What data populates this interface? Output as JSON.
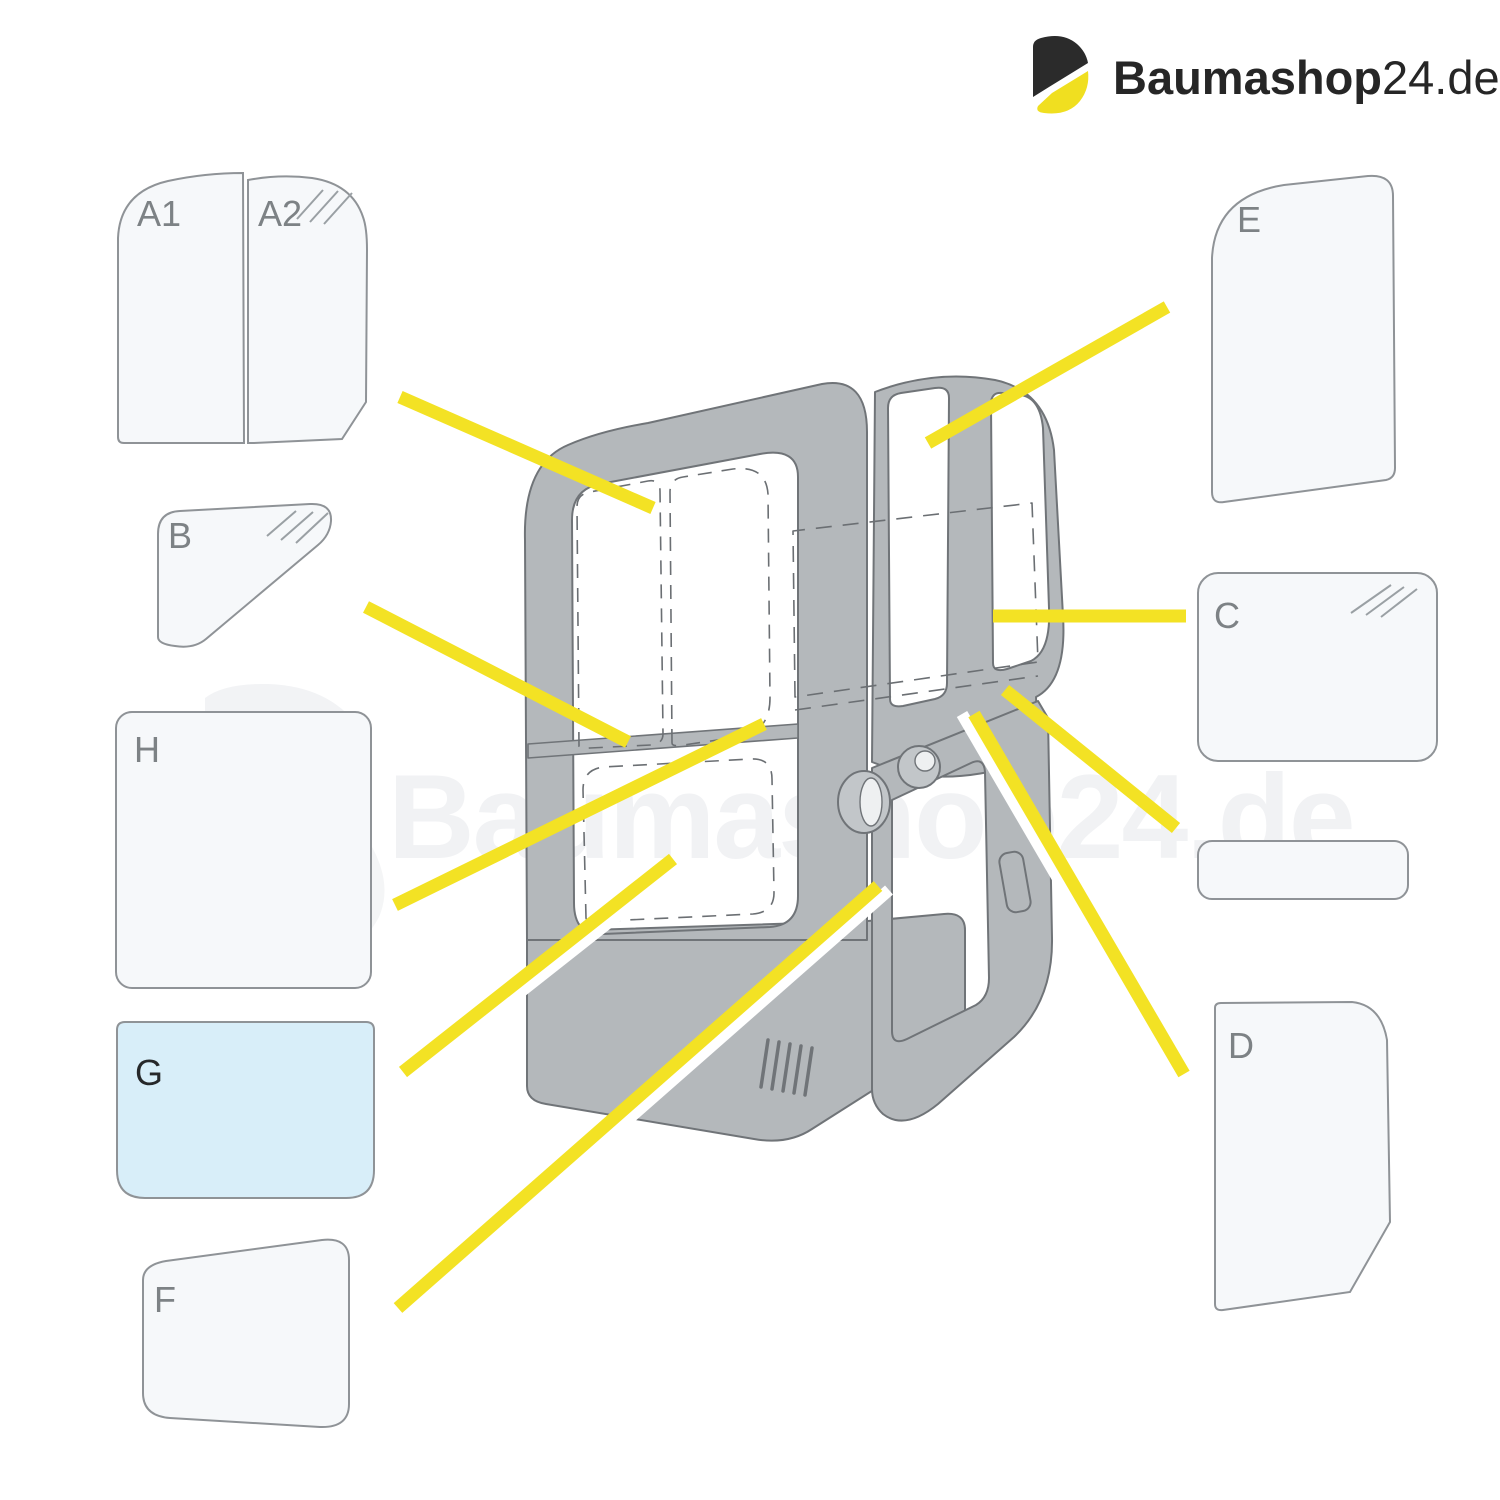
{
  "brand": {
    "name_bold": "Baumashop",
    "name_number": "24",
    "name_tld": ".de"
  },
  "watermark_text": "Baumashop24.de",
  "panels": {
    "a1": {
      "label": "A1"
    },
    "a2": {
      "label": "A2"
    },
    "b": {
      "label": "B"
    },
    "c": {
      "label": "C"
    },
    "d": {
      "label": "D"
    },
    "e": {
      "label": "E"
    },
    "f": {
      "label": "F"
    },
    "g": {
      "label": "G"
    },
    "h": {
      "label": "H"
    }
  },
  "colors": {
    "accent_yellow": "#f3e224",
    "logo_dark": "#2b2b2b",
    "glass_fill": "#f6f8fa",
    "glass_highlight_blue": "#d8eef9",
    "cab_gray": "#b4b8bb",
    "outline_gray": "#707478",
    "label_gray": "#7d8285"
  }
}
